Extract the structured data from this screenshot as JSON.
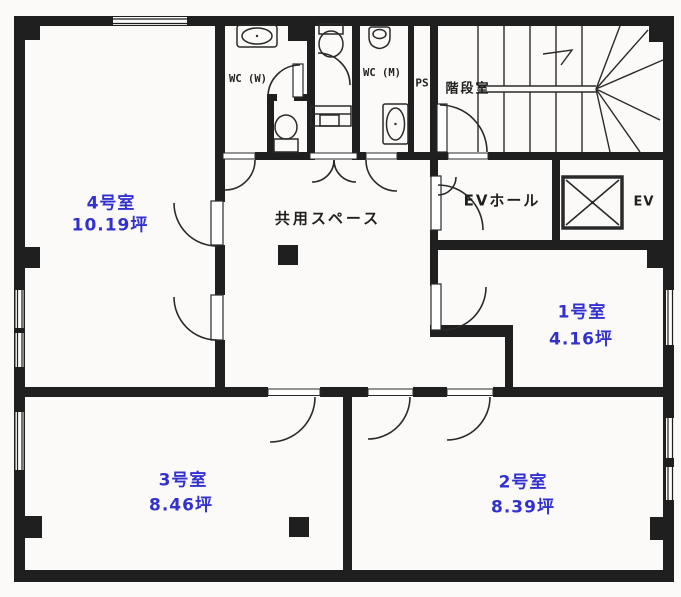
{
  "plan": {
    "rooms": [
      {
        "id": "room4",
        "name": "4号室",
        "area": "10.19坪"
      },
      {
        "id": "room1",
        "name": "1号室",
        "area": "4.16坪"
      },
      {
        "id": "room2",
        "name": "2号室",
        "area": "8.39坪"
      },
      {
        "id": "room3",
        "name": "3号室",
        "area": "8.46坪"
      }
    ],
    "labels": {
      "common_space": "共用スペース",
      "stairwell": "階段室",
      "ev_hall": "EVホール",
      "elevator": "EV",
      "wc_women": "WC (W)",
      "wc_men": "WC (M)",
      "pipe_shaft": "PS"
    },
    "colors": {
      "room_label": "#3231d0",
      "ink": "#1f1f1f",
      "paper": "#fbfaf8"
    }
  }
}
